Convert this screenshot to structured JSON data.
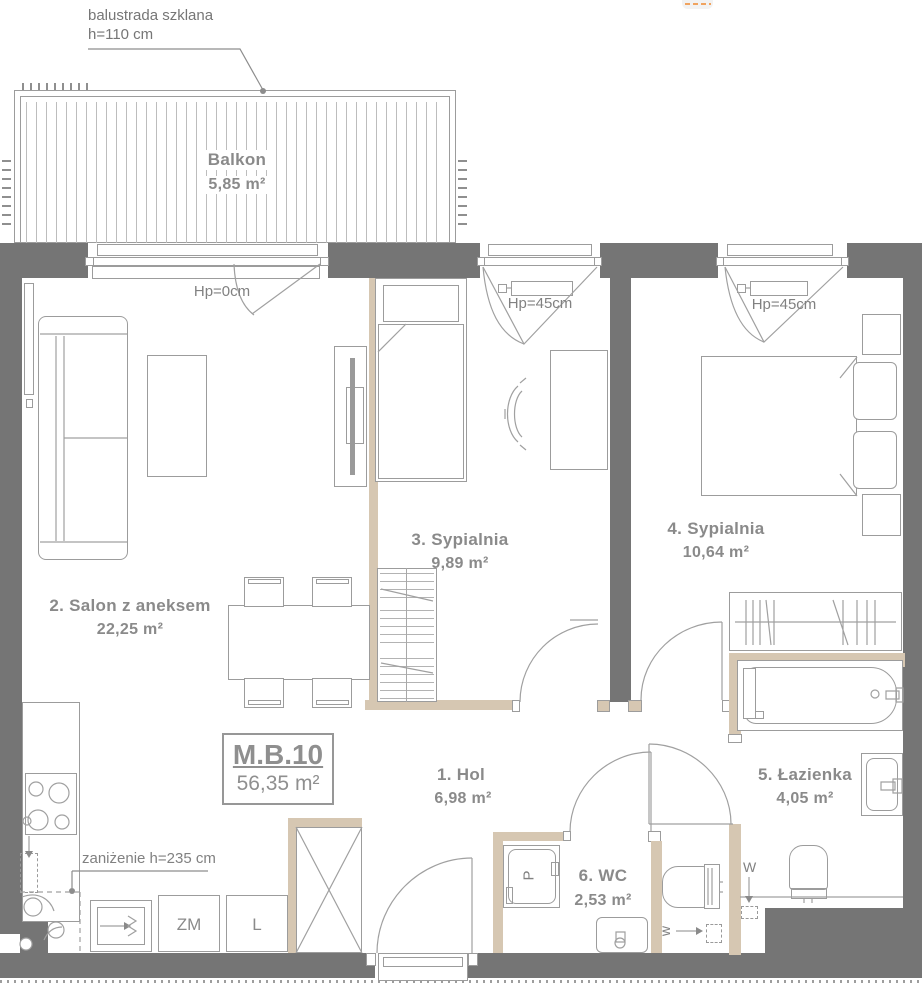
{
  "unit": {
    "code": "M.B.10",
    "area": "56,35 m²"
  },
  "rooms": {
    "balkon": {
      "name": "Balkon",
      "area": "5,85 m²"
    },
    "hol": {
      "name": "1. Hol",
      "area": "6,98 m²"
    },
    "salon": {
      "name": "2. Salon z aneksem",
      "area": "22,25 m²"
    },
    "sypialnia3": {
      "name": "3. Sypialnia",
      "area": "9,89 m²"
    },
    "sypialnia4": {
      "name": "4. Sypialnia",
      "area": "10,64 m²"
    },
    "lazienka": {
      "name": "5. Łazienka",
      "area": "4,05 m²"
    },
    "wc": {
      "name": "6. WC",
      "area": "2,53 m²"
    }
  },
  "annotations": {
    "balustrade_line1": "balustrada szklana",
    "balustrade_line2": "h=110 cm",
    "lowered_ceiling": "zaniżenie h=235 cm",
    "window_hp0": "Hp=0cm",
    "window_hp45_bedroom3": "Hp=45cm",
    "window_hp45_bedroom4": "Hp=45cm",
    "water_bathroom": "W",
    "water_wc": "w"
  },
  "appliances": {
    "washer": "P",
    "dishwasher": "ZM",
    "fridge": "L"
  },
  "colors": {
    "wall": "#757575",
    "partition": "#d6c7b2",
    "linework": "#a0a0a0",
    "text": "#8a8a8a",
    "accent_orange": "#f0a35f"
  }
}
